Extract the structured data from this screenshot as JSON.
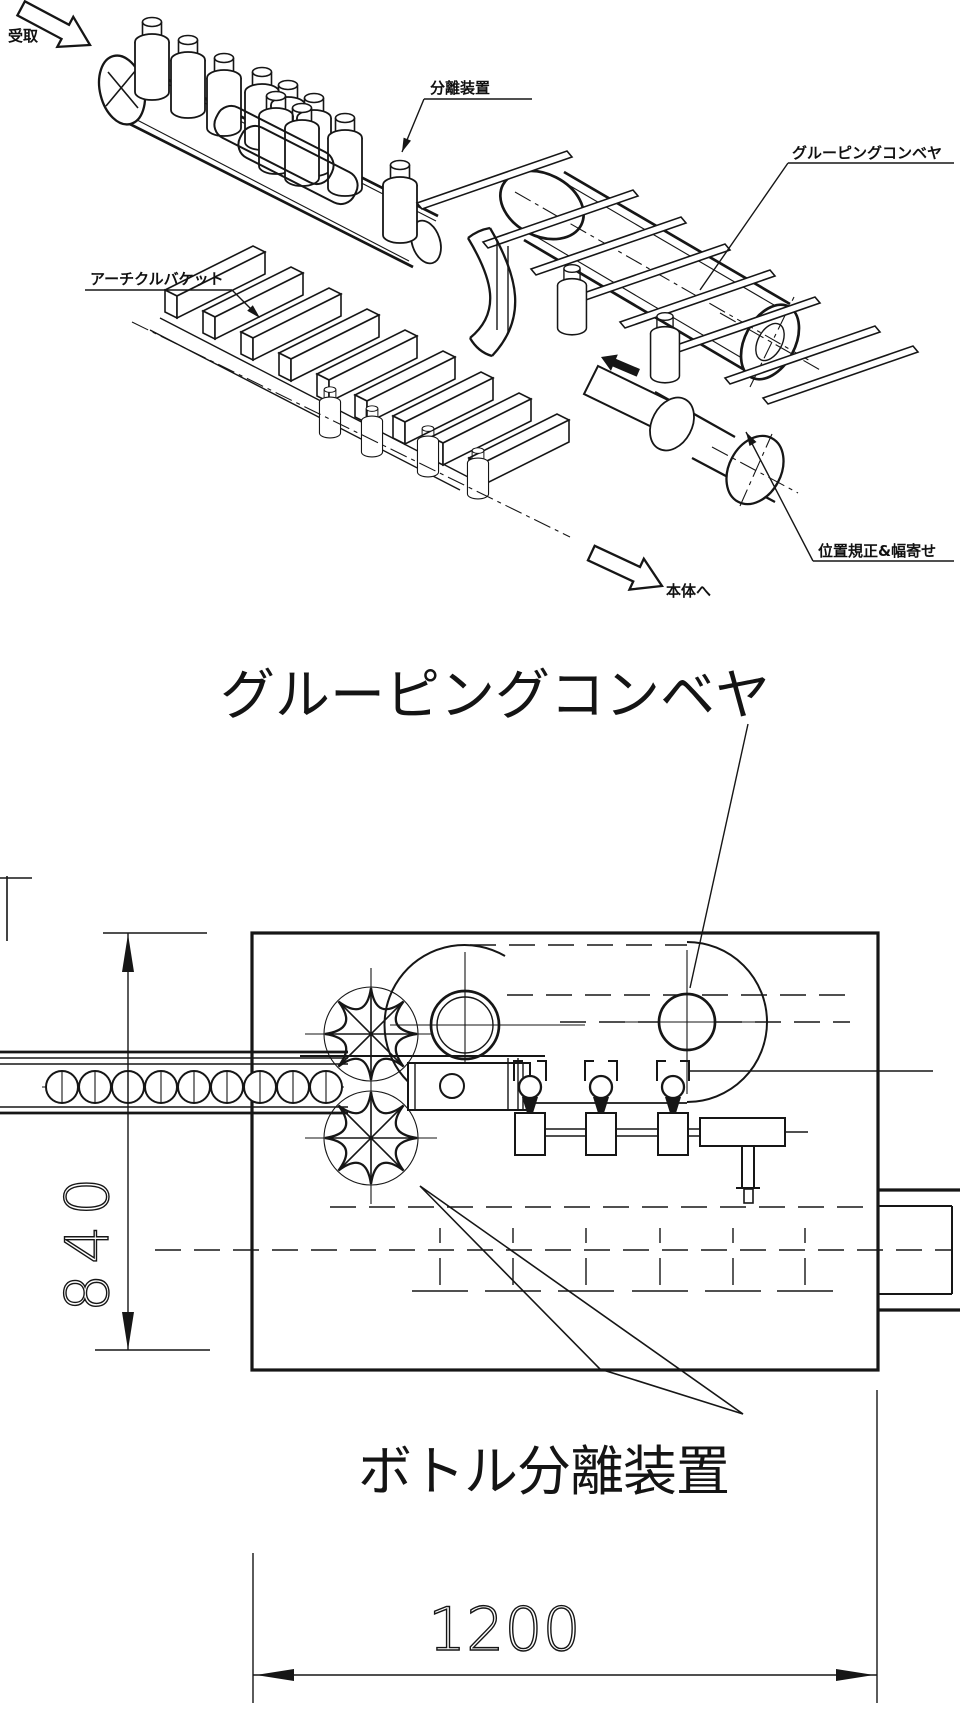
{
  "drawing": {
    "colors": {
      "line": "#161616",
      "background": "#ffffff"
    },
    "iso_view": {
      "receive_label": "受取",
      "separator_label": "分離装置",
      "grouping_conveyor_label": "グルーピングコンベヤ",
      "article_bucket_label": "アーチクルバケット",
      "positioning_label": "位置規正&幅寄せ",
      "to_main_body_label": "本体へ"
    },
    "plan_view": {
      "title": "グルーピングコンベヤ",
      "bottle_separator_label": "ボトル分離装置",
      "dimensions": {
        "height_mm": "840",
        "width_mm": "1200"
      }
    }
  }
}
